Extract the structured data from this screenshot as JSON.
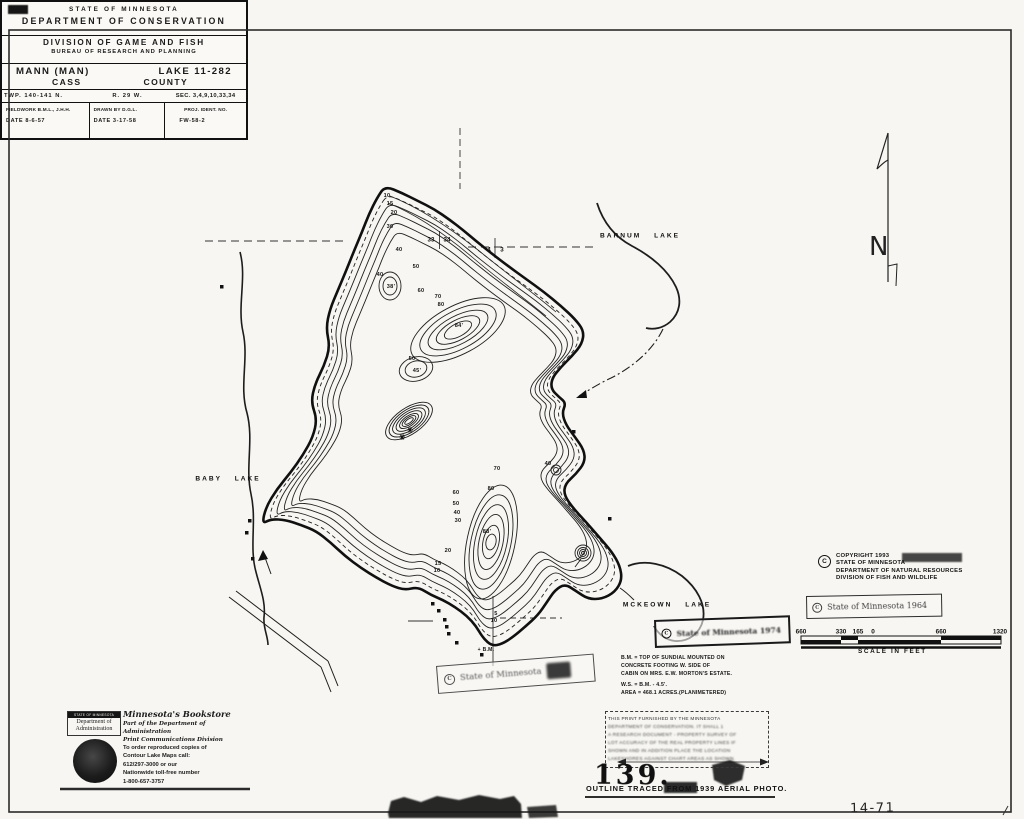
{
  "map": {
    "lake_labels": [
      {
        "t": "BARNUM LAKE",
        "x": 640,
        "y": 236
      },
      {
        "t": "BABY LAKE",
        "x": 228,
        "y": 479
      },
      {
        "t": "MCKEOWN LAKE",
        "x": 667,
        "y": 605
      }
    ],
    "section_numbers": [
      {
        "t": "33",
        "x": 431,
        "y": 240
      },
      {
        "t": "34",
        "x": 447,
        "y": 240
      },
      {
        "t": "4",
        "x": 489,
        "y": 250
      },
      {
        "t": "3",
        "x": 502,
        "y": 250
      }
    ],
    "depth_labels": [
      {
        "t": "10",
        "x": 387,
        "y": 196
      },
      {
        "t": "15",
        "x": 390,
        "y": 204
      },
      {
        "t": "20",
        "x": 394,
        "y": 213
      },
      {
        "t": "30",
        "x": 390,
        "y": 227
      },
      {
        "t": "40",
        "x": 399,
        "y": 250
      },
      {
        "t": "50",
        "x": 416,
        "y": 267
      },
      {
        "t": "40",
        "x": 380,
        "y": 275
      },
      {
        "t": "38'",
        "x": 391,
        "y": 287
      },
      {
        "t": "60",
        "x": 421,
        "y": 291
      },
      {
        "t": "70",
        "x": 438,
        "y": 297
      },
      {
        "t": "80",
        "x": 441,
        "y": 305
      },
      {
        "t": "84'",
        "x": 459,
        "y": 326
      },
      {
        "t": "50",
        "x": 412,
        "y": 359
      },
      {
        "t": "45'",
        "x": 417,
        "y": 371
      },
      {
        "t": "40",
        "x": 548,
        "y": 464
      },
      {
        "t": "70",
        "x": 497,
        "y": 469
      },
      {
        "t": "60",
        "x": 456,
        "y": 493
      },
      {
        "t": "50",
        "x": 456,
        "y": 504
      },
      {
        "t": "40",
        "x": 457,
        "y": 513
      },
      {
        "t": "30",
        "x": 458,
        "y": 521
      },
      {
        "t": "80",
        "x": 491,
        "y": 489
      },
      {
        "t": "88'",
        "x": 487,
        "y": 532
      },
      {
        "t": "20",
        "x": 448,
        "y": 551
      },
      {
        "t": "15",
        "x": 438,
        "y": 564
      },
      {
        "t": "10",
        "x": 437,
        "y": 571
      },
      {
        "t": "5",
        "x": 496,
        "y": 614
      },
      {
        "t": "10",
        "x": 494,
        "y": 621
      },
      {
        "t": "+ B.M.",
        "x": 486,
        "y": 650,
        "s": 5
      }
    ]
  },
  "north": {
    "label": "N"
  },
  "copyright": {
    "symbol": "C",
    "lines": [
      "COPYRIGHT 1993",
      "STATE OF MINNESOTA",
      "DEPARTMENT OF NATURAL RESOURCES",
      "DIVISION OF FISH AND WILDLIFE"
    ]
  },
  "stamp_1964": {
    "symbol": "C",
    "text": "State of Minnesota 1964"
  },
  "stamp_1974": {
    "symbol": "C",
    "text": "State of Minnesota 1974"
  },
  "stamp_tilted": {
    "symbol": "C",
    "text": "State of Minnesota"
  },
  "scale_bar": {
    "numbers": [
      {
        "t": "660",
        "x": 801,
        "y": 632
      },
      {
        "t": "330",
        "x": 841,
        "y": 632
      },
      {
        "t": "165",
        "x": 858,
        "y": 632
      },
      {
        "t": "0",
        "x": 873,
        "y": 632
      },
      {
        "t": "660",
        "x": 941,
        "y": 632
      },
      {
        "t": "1320",
        "x": 1000,
        "y": 632
      }
    ],
    "caption": "SCALE IN FEET"
  },
  "survey_note": {
    "lines": [
      "B.M. = TOP OF SUNDIAL MOUNTED ON",
      "CONCRETE FOOTING W. SIDE OF",
      "CABIN ON MRS. E.W. MORTON'S ESTATE.",
      "W.S. = B.M. - 4.5'.",
      "AREA = 468.1 ACRES.(PLANIMETERED)"
    ]
  },
  "print_stamp": {
    "lines": [
      "THIS PRINT FURNISHED BY THE MINNESOTA",
      "DEPARTMENT OF CONSERVATION. IT SHALL 1",
      "A RESEARCH DOCUMENT - PROPERTY SURVEY OF",
      "LOT ACCURACY OF THE REAL PROPERTY LINES IF",
      "SHOWN AND IN ADDITION PLACE THE LOCATION",
      "LAKESHORES AGAINST CHART AREAS AS SHOWN."
    ]
  },
  "stamp_139": {
    "number": "139."
  },
  "outline_note": {
    "text": "OUTLINE TRACED FROM 1939 AERIAL PHOTO."
  },
  "handwritten": {
    "text": "14-71"
  },
  "title_block": {
    "agency_line1": "STATE OF MINNESOTA",
    "agency_line2": "DEPARTMENT OF CONSERVATION",
    "division_line1": "DIVISION OF GAME AND FISH",
    "division_line2": "BUREAU OF RESEARCH AND PLANNING",
    "lake_name": "MANN (MAN)",
    "lake_id": "LAKE 11-282",
    "county_name": "CASS",
    "county_word": "COUNTY",
    "township": "TWP. 140-141 N.",
    "range": "R. 29 W.",
    "sections": "SEC. 3,4,9,10,33,34",
    "fieldwork_label": "FIELDWORK B.M.L., J.H.H.",
    "fieldwork_date": "DATE 8-6-57",
    "drawnby_label": "DRAWN BY D.G.L.",
    "drawnby_date": "DATE 3-17-58",
    "proj_label": "PROJ. IDENT. NO.",
    "proj_value": "FW-58-2"
  },
  "bookstore": {
    "header_small": "STATE OF MINNESOTA",
    "header_dept": "Department of Administration",
    "lines": [
      "Minnesota's Bookstore",
      "Part of the Department of Administration",
      "Print Communications Division",
      "To order reproduced copies of",
      "Contour Lake Maps call:",
      "612/297-3000 or our",
      "Nationwide toll-free number",
      "1-800-657-3757"
    ]
  }
}
